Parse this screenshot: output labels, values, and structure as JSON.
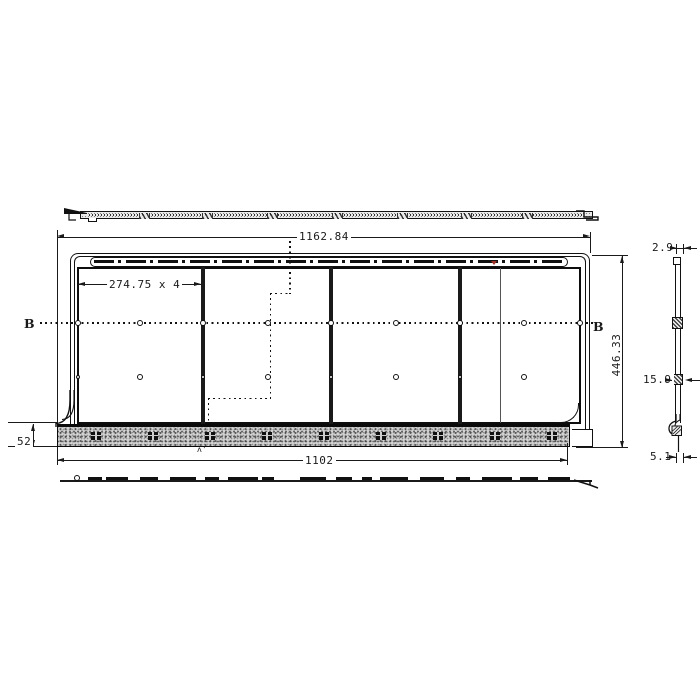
{
  "title": "panel-technical-drawing",
  "dims": {
    "overall_width": "1162.84",
    "module_pitch": "274.75 x 4",
    "base_width": "1102",
    "base_height": "52",
    "overall_height": "446.33",
    "top_thickness": "2.9",
    "clip_depth": "15.9",
    "bottom_thickness": "5.1"
  },
  "sections": {
    "left_label": "B",
    "right_label": "B",
    "cut_mark": "ʌ'"
  },
  "colors": {
    "line": "#1a1a1a",
    "accent": "#a03226",
    "hatch_fill": "#d2d2d2"
  }
}
